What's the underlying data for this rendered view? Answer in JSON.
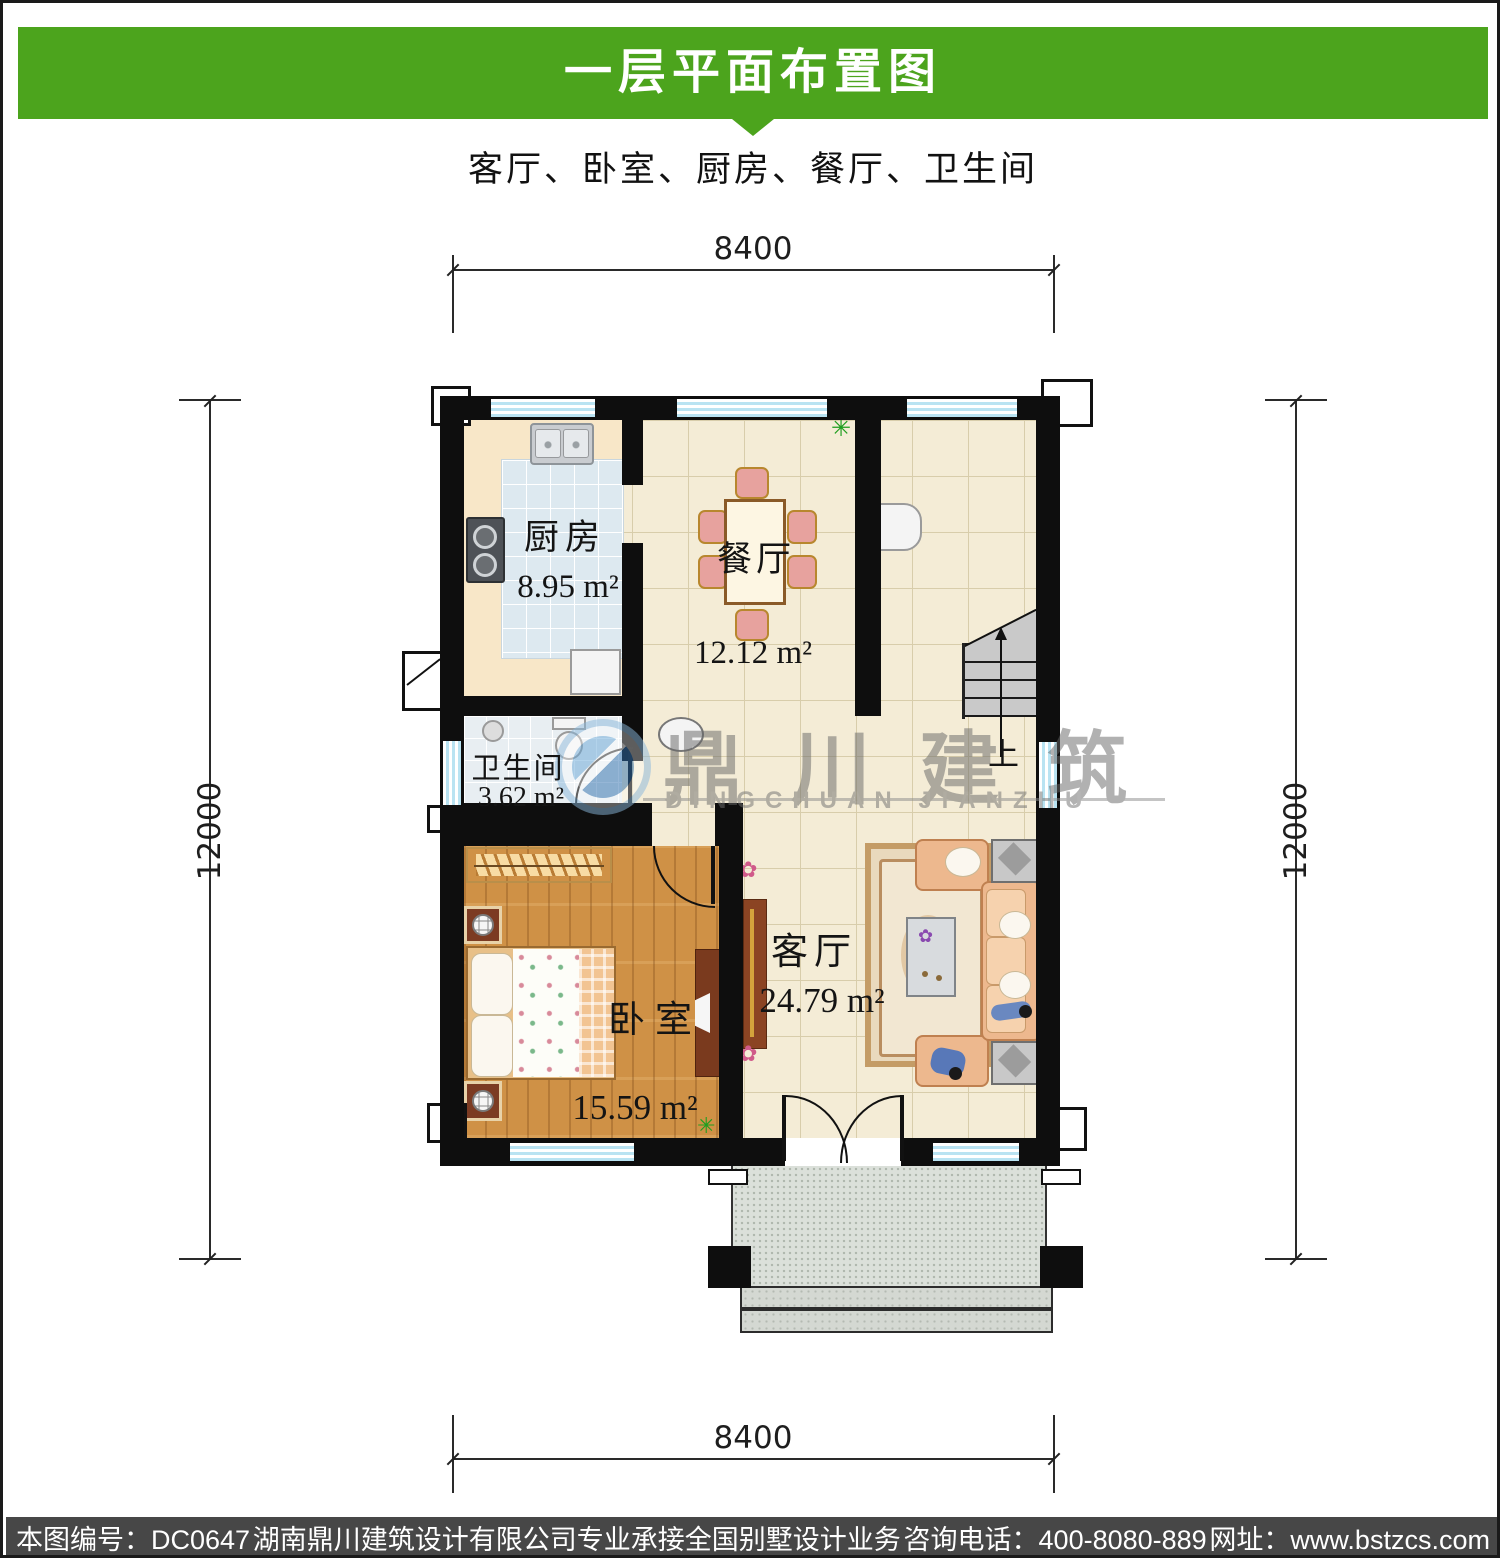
{
  "header": {
    "title": "一层平面布置图",
    "subtitle": "客厅、卧室、厨房、餐厅、卫生间",
    "banner_color": "#4ca41d"
  },
  "dimensions": {
    "top": "8400",
    "bottom": "8400",
    "left": "12000",
    "right": "12000"
  },
  "rooms": {
    "kitchen": {
      "name": "厨房",
      "area": "8.95 m²"
    },
    "dining": {
      "name": "餐厅",
      "area": "12.12 m²"
    },
    "bath": {
      "name": "卫生间",
      "area": "3.62 m²"
    },
    "bedroom": {
      "name": "卧室",
      "area": "15.59 m²"
    },
    "living": {
      "name": "客厅",
      "area": "24.79 m²"
    }
  },
  "stairs": {
    "up_label": "上"
  },
  "watermark": {
    "cn": "鼎川建筑",
    "en": "DINGCHUAN JIANZHU"
  },
  "decor": {
    "plant_icon": "✳",
    "flower_icon": "✿"
  },
  "footer": {
    "items": [
      "本图编号：DC0647",
      "湖南鼎川建筑设计有限公司专业承接全国别墅设计业务",
      "咨询电话：400-8080-889",
      "网址：www.bstzcs.com"
    ],
    "bar_color": "#474747"
  }
}
